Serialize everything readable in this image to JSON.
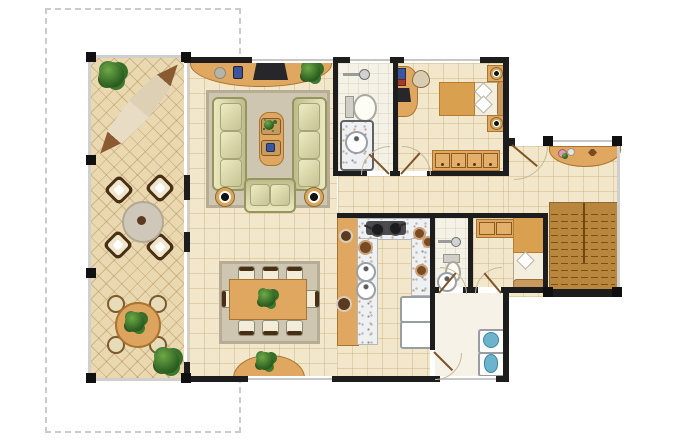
{
  "figure": {
    "type": "residential-floor-plan",
    "style": "color architectural rendering, top-down view",
    "background": "#ffffff"
  },
  "palette": {
    "wall": "#1d1d1d",
    "window_glass": "#c6c6c6",
    "property_line": "#cbcbcb",
    "interior_tile": "#f2e7cb",
    "patio_tile": "#e9d8b0",
    "bath_floor": "#f4f1e6",
    "wood": "#dfa75f",
    "granite_counter": "#eef0f1",
    "rug": "#cec6b1",
    "sofa": "#d3d1a0",
    "stairs": "#b8863d",
    "plant_green": "#2f6423",
    "water_fixture_blue": "#6cb4ce",
    "lamp_shade": "#d9a85c",
    "blanket_tan": "#d9a050"
  },
  "areas": {
    "patio": {
      "label": "terrace patio",
      "items": {
        "hammock": 1,
        "lounge_chairs": 4,
        "round_side_table": 1,
        "garden_table": 1,
        "garden_seats": 4,
        "potted_plants": 3
      }
    },
    "living": {
      "label": "living room",
      "items": {
        "media_console": 1,
        "tv": 1,
        "sofas": 2,
        "loveseat": 1,
        "coffee_table": 1,
        "floor_lamps": 2,
        "rug": 1,
        "console_plant": 1
      }
    },
    "dining": {
      "label": "dining room",
      "items": {
        "table": 1,
        "chairs": 8,
        "centerpiece_plant": 1,
        "window_planter": 1
      }
    },
    "bath_main": {
      "label": "main bathroom",
      "items": {
        "shower": 1,
        "toilet": 1,
        "vanity_sink": 1
      }
    },
    "bedroom": {
      "label": "bedroom",
      "items": {
        "double_bed": 1,
        "nightstands": 2,
        "table_lamps": 2,
        "desk": 1,
        "desk_chair": 1,
        "wardrobe_doors": 4
      }
    },
    "foyer": {
      "label": "entry foyer",
      "items": {
        "console_table": 1,
        "flower_vases": 2
      }
    },
    "stairs": {
      "label": "staircase",
      "items": {
        "flights": 1
      }
    },
    "kitchen": {
      "label": "kitchen",
      "items": {
        "wood_bar": 1,
        "u_shaped_counter": 1,
        "cooktop_pans": 2,
        "sinks": 2,
        "appliances": 2,
        "serving_plates": 2
      }
    },
    "bath_service": {
      "label": "service bathroom",
      "items": {
        "shower": 1,
        "toilet": 1,
        "sink": 1
      }
    },
    "maid_room": {
      "label": "service bedroom",
      "items": {
        "single_bed": 1,
        "wardrobe_doors": 2
      }
    },
    "laundry": {
      "label": "laundry area",
      "items": {
        "washer": 1,
        "laundry_tub": 1
      }
    }
  }
}
